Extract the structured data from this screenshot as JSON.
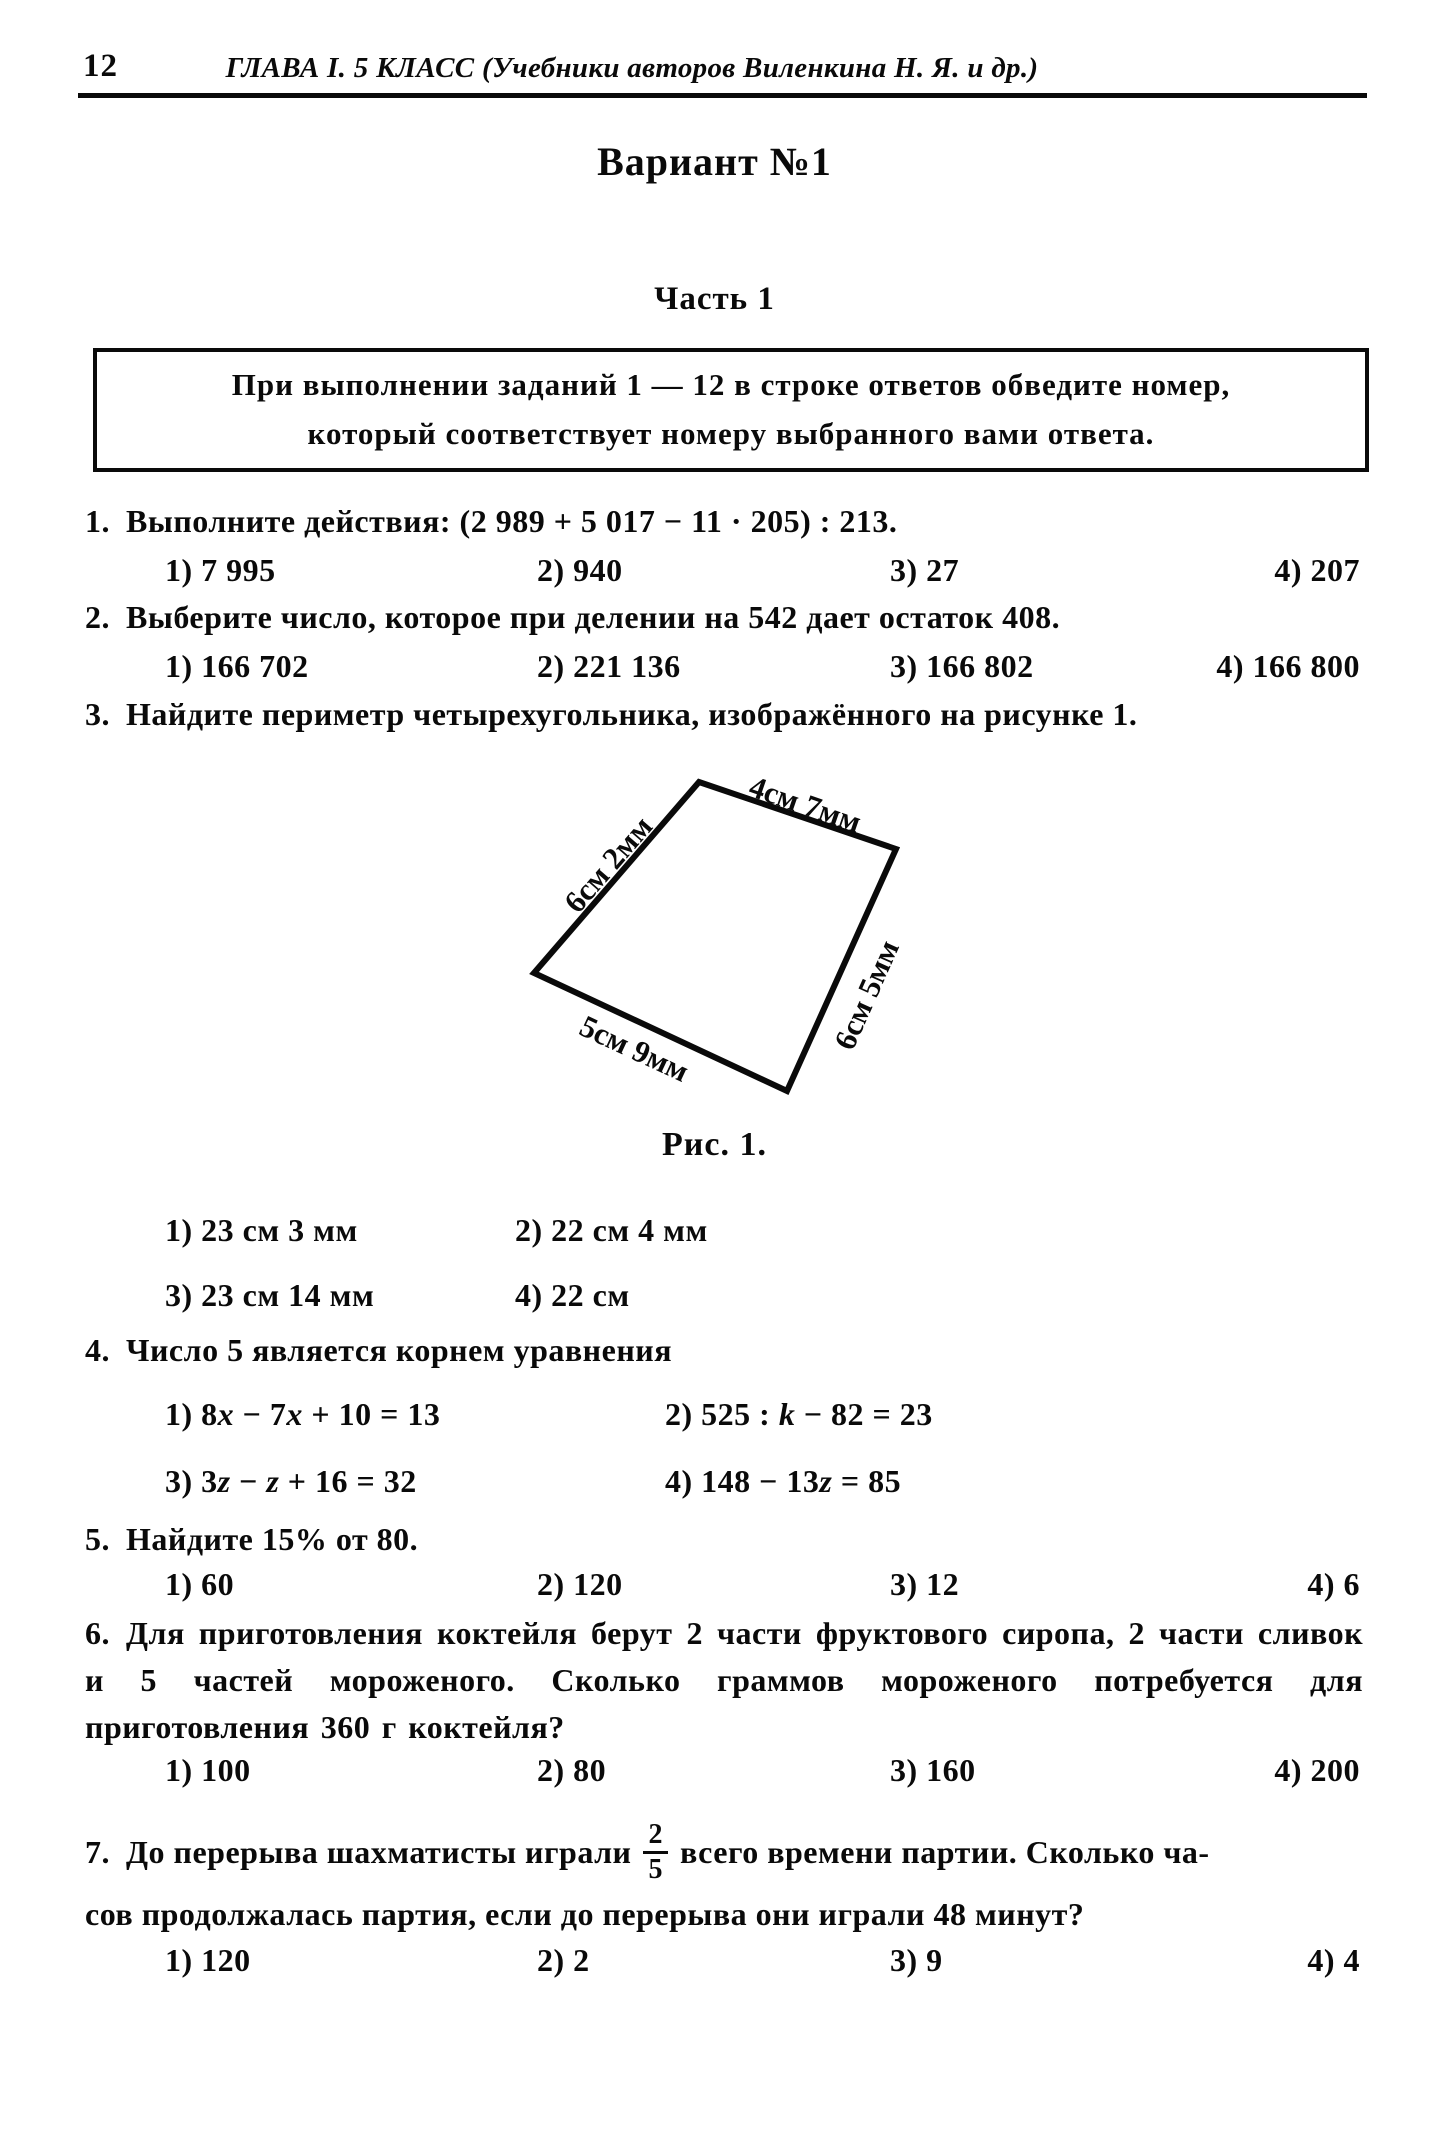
{
  "header": {
    "page_number": "12",
    "title": "ГЛАВА I. 5 КЛАСС (Учебники авторов Виленкина Н. Я. и др.)"
  },
  "variant_title": "Вариант №1",
  "part_title": "Часть 1",
  "instruction": {
    "line1": "При выполнении заданий 1 — 12 в строке ответов обведите номер,",
    "line2": "который соответствует номеру выбранного вами ответа."
  },
  "q1": {
    "num": "1.",
    "text": "Выполните действия: (2 989 + 5 017 − 11 · 205) : 213.",
    "a": [
      "1) 7 995",
      "2) 940",
      "3) 27",
      "4) 207"
    ]
  },
  "q2": {
    "num": "2.",
    "text": "Выберите число, которое при делении на 542 дает остаток 408.",
    "a": [
      "1) 166 702",
      "2) 221 136",
      "3) 166 802",
      "4) 166 800"
    ]
  },
  "q3": {
    "num": "3.",
    "text": "Найдите периметр четырехугольника, изображённого на рисунке 1.",
    "a": [
      "1) 23 см 3 мм",
      "2) 22 см 4 мм",
      "3) 23 см 14 мм",
      "4) 22 см"
    ]
  },
  "figure": {
    "label_left": "6см 2мм",
    "label_top": "4см 7мм",
    "label_right": "6см 5мм",
    "label_bottom": "5см 9мм",
    "caption": "Рис. 1."
  },
  "q4": {
    "num": "4.",
    "text": "Число 5 является корнем уравнения",
    "eq1": [
      {
        "t": "1) 8"
      },
      {
        "t": "x",
        "i": true
      },
      {
        "t": " − 7"
      },
      {
        "t": "x",
        "i": true
      },
      {
        "t": " + 10 = 13"
      }
    ],
    "eq2": [
      {
        "t": "2) 525 : "
      },
      {
        "t": "k",
        "i": true
      },
      {
        "t": " − 82 = 23"
      }
    ],
    "eq3": [
      {
        "t": "3) 3"
      },
      {
        "t": "z",
        "i": true
      },
      {
        "t": " − "
      },
      {
        "t": "z",
        "i": true
      },
      {
        "t": " + 16 = 32"
      }
    ],
    "eq4": [
      {
        "t": "4) 148 − 13"
      },
      {
        "t": "z",
        "i": true
      },
      {
        "t": " = 85"
      }
    ]
  },
  "q5": {
    "num": "5.",
    "text": "Найдите 15% от 80.",
    "a": [
      "1) 60",
      "2) 120",
      "3) 12",
      "4) 6"
    ]
  },
  "q6": {
    "num": "6.",
    "text": "Для приготовления коктейля берут 2 части фруктового сиропа, 2 части сливок и 5 частей мороженого. Сколько граммов мороженого потребуется для приготовления 360 г коктейля?",
    "a": [
      "1) 100",
      "2) 80",
      "3) 160",
      "4) 200"
    ]
  },
  "q7": {
    "num": "7.",
    "pre": "До перерыва шахматисты играли",
    "frac_num": "2",
    "frac_den": "5",
    "post": "всего времени партии. Сколько ча-",
    "line2": "сов продолжалась партия, если до перерыва они играли 48 минут?",
    "a": [
      "1) 120",
      "2) 2",
      "3) 9",
      "4) 4"
    ]
  }
}
